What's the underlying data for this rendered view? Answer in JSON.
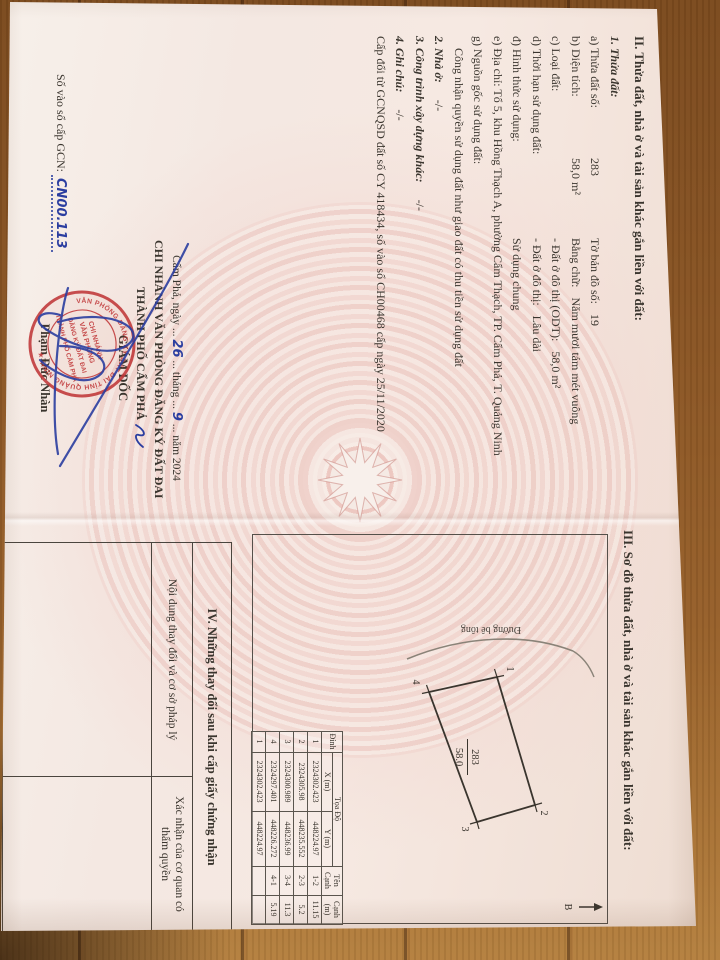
{
  "colors": {
    "wood": "#96602a",
    "paper": "#f6ede6",
    "drum_pink": "#ecc8c2",
    "ink": "#3a352e",
    "stamp_red": "#c13b3c",
    "pen_blue": "#2b3ea0"
  },
  "section2": {
    "heading": "II. Thửa đất, nhà ở và tài sản khác gắn liền với đất:",
    "sub": "1. Thửa đất:",
    "rows": [
      {
        "l": "a) Thửa đất số:",
        "v": "283",
        "l2": "Tờ bản đồ số:",
        "v2": "19"
      },
      {
        "l": "b) Diện tích:",
        "v": "58,0 m²",
        "l2": "Bằng chữ:",
        "v2": "Năm mươi tám mét vuông"
      },
      {
        "l": "c) Loại đất:",
        "v": "",
        "l2": "- Đất ở đô thị (ODT):",
        "v2": "58,0 m²"
      },
      {
        "l": "d) Thời hạn sử dụng đất:",
        "v": "",
        "l2": "- Đất ở đô thị:",
        "v2": "Lâu dài"
      },
      {
        "l": "đ) Hình thức sử dụng:",
        "v": "",
        "l2": "Sử dụng chung",
        "v2": ""
      }
    ],
    "address": "e) Địa chỉ: Tổ 5, khu Hồng Thạch A, phường Cẩm Thạch, TP. Cẩm Phả, T. Quảng Ninh",
    "origin_label": "g) Nguồn gốc sử dụng đất:",
    "origin_value": "Công nhận quyền sử dụng đất như giao đất có thu tiền sử dụng đất",
    "item2_label": "2. Nhà ở:",
    "item2_value": "-/-",
    "item3_label": "3. Công trình xây dựng khác:",
    "item3_value": "-/-",
    "item4_label": "4. Ghi chú:",
    "item4_value": "-/-",
    "note": "Cấp đổi từ GCNQSD đất số CY 418434, số vào sổ CH00468 cấp ngày 25/11/2020"
  },
  "registry": {
    "label": "Số vào sổ cấp GCN:",
    "value": "CN00.113"
  },
  "signing": {
    "place_date": {
      "pre": "Cẩm Phả, ngày",
      "day": "26",
      "mid": "tháng",
      "month": "9",
      "post": "năm 2024",
      "dots": "..."
    },
    "office1": "CHI NHÁNH VĂN PHÒNG ĐĂNG KÝ ĐẤT ĐAI",
    "office2": "THÀNH PHỐ CẨM PHẢ",
    "role": "GIÁM ĐỐC",
    "signer": "Phạm Đức Nhàn",
    "stamp": {
      "ring": "VĂN PHÒNG ĐĂNG KÝ ĐẤT ĐAI TỈNH QUẢNG NINH",
      "star": "★",
      "center": [
        "CHI NHÁNH",
        "VĂN PHÒNG",
        "ĐĂNG KÝ ĐẤT ĐAI",
        "THÀNH PHỐ CẨM PHẢ"
      ]
    }
  },
  "section3": {
    "heading": "III. Sơ đồ thửa đất, nhà ở và tài sản khác gắn liền với đất:",
    "parcel_number": "283",
    "parcel_area": "58.0",
    "road_label": "Đường bê tông",
    "north_label": "B",
    "vertex_labels": [
      "1",
      "2",
      "3",
      "4"
    ]
  },
  "coord_table": {
    "col_point": "Đỉnh",
    "col_group": "Tọa Độ",
    "col_x": "X (m)",
    "col_y": "Y (m)",
    "col_edge": "Tên Cạnh",
    "col_length": "Cạnh (m)",
    "rows": [
      [
        "1",
        "2324302.423",
        "448224.97",
        "1-2",
        "11.15"
      ],
      [
        "2",
        "2324305.98",
        "448235.552",
        "2-3",
        "5.2"
      ],
      [
        "3",
        "2324300.989",
        "448236.99",
        "3-4",
        "11.3"
      ],
      [
        "4",
        "2324297.401",
        "448226.272",
        "4-1",
        "5.19"
      ],
      [
        "1",
        "2324302.423",
        "448224.97",
        "",
        ""
      ]
    ]
  },
  "section4": {
    "heading": "IV. Những thay đổi sau khi cấp giấy chứng nhận",
    "col_left": "Nội dung thay đổi và cơ sở pháp lý",
    "col_right": "Xác nhận của cơ quan có thẩm quyền"
  }
}
